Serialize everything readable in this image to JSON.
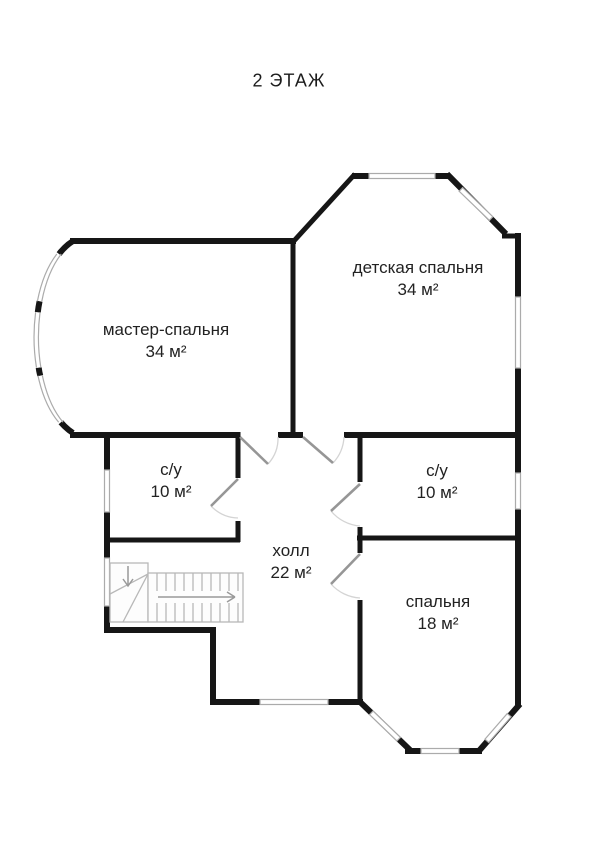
{
  "title": "2 ЭТАЖ",
  "rooms": [
    {
      "name": "мастер-спальня",
      "area": "34 м²"
    },
    {
      "name": "детская спальня",
      "area": "34 м²"
    },
    {
      "name": "с/у",
      "area": "10 м²"
    },
    {
      "name": "с/у",
      "area": "10 м²"
    },
    {
      "name": "холл",
      "area": "22 м²"
    },
    {
      "name": "спальня",
      "area": "18 м²"
    }
  ],
  "colors": {
    "wall": "#161616",
    "window": "#ababab",
    "door_leaf": "#969696",
    "door_arc": "#d4d4d4",
    "stairs": "#b8b8b8",
    "text": "#222222"
  }
}
